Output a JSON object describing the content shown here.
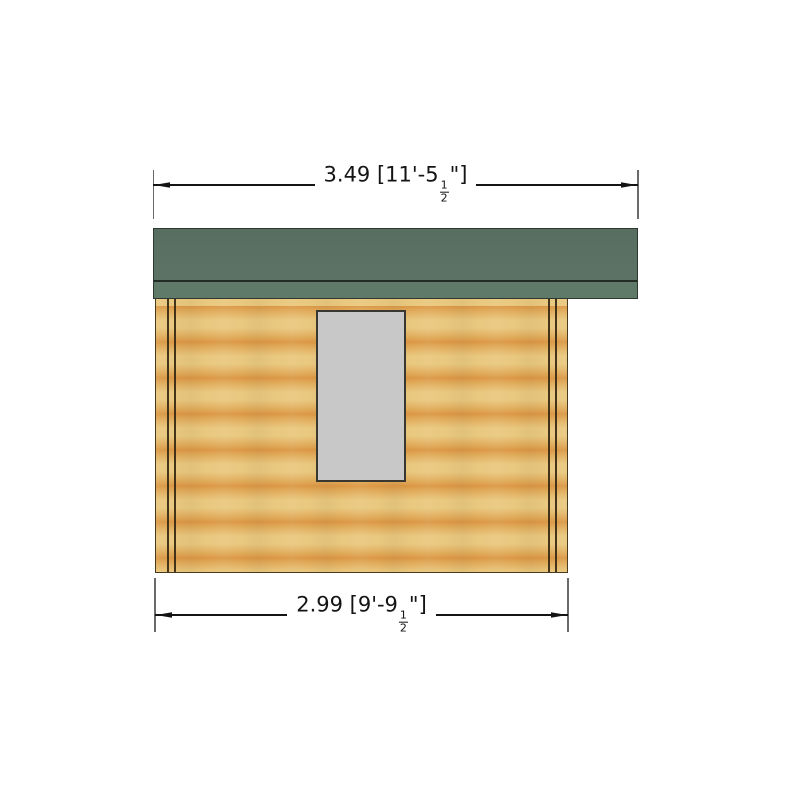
{
  "drawing": {
    "kind": "building-side-elevation",
    "top_dimension": {
      "text": "3.49 [11'-5",
      "fraction_numerator": "1",
      "fraction_denominator": "2",
      "suffix": "\"]"
    },
    "bottom_dimension": {
      "text": "2.99 [9'-9",
      "fraction_numerator": "1",
      "fraction_denominator": "2",
      "suffix": "\"]"
    },
    "colors": {
      "roof": "#5b7164",
      "roof_fascia": "#5f7a69",
      "wood_light": "#e9c87f",
      "wood_dark": "#db9845",
      "window_fill": "#c8c8c8",
      "dimension_line": "#141414",
      "extension_line": "#6a6a6a"
    }
  }
}
